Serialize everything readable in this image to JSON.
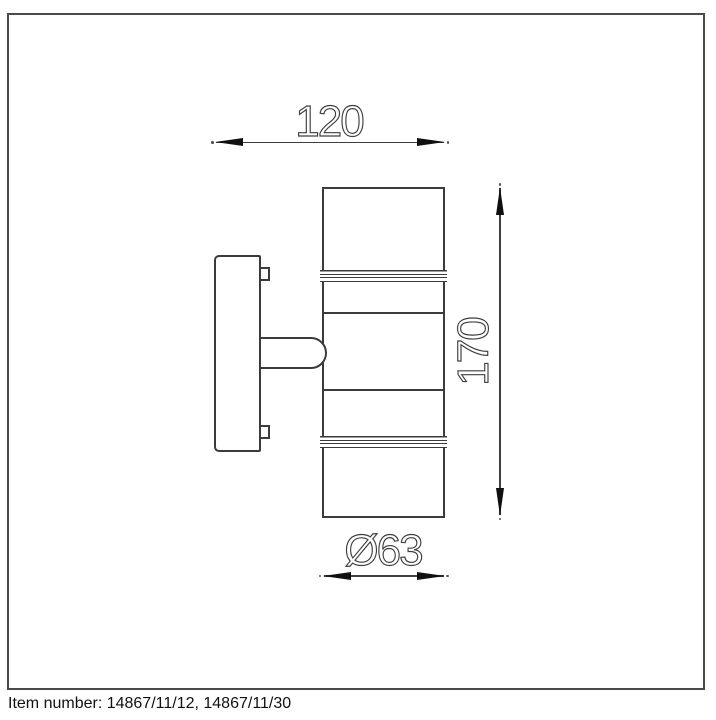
{
  "dimensions": {
    "width": {
      "label": "120"
    },
    "height": {
      "label": "170"
    },
    "diameter": {
      "label": "Ø63"
    }
  },
  "footer": {
    "item_number": "Item number: 14867/11/12, 14867/11/30"
  },
  "colors": {
    "line": "#3b3b3b",
    "arrow": "#101010",
    "frame": "#4a4a4a",
    "background": "#ffffff"
  }
}
